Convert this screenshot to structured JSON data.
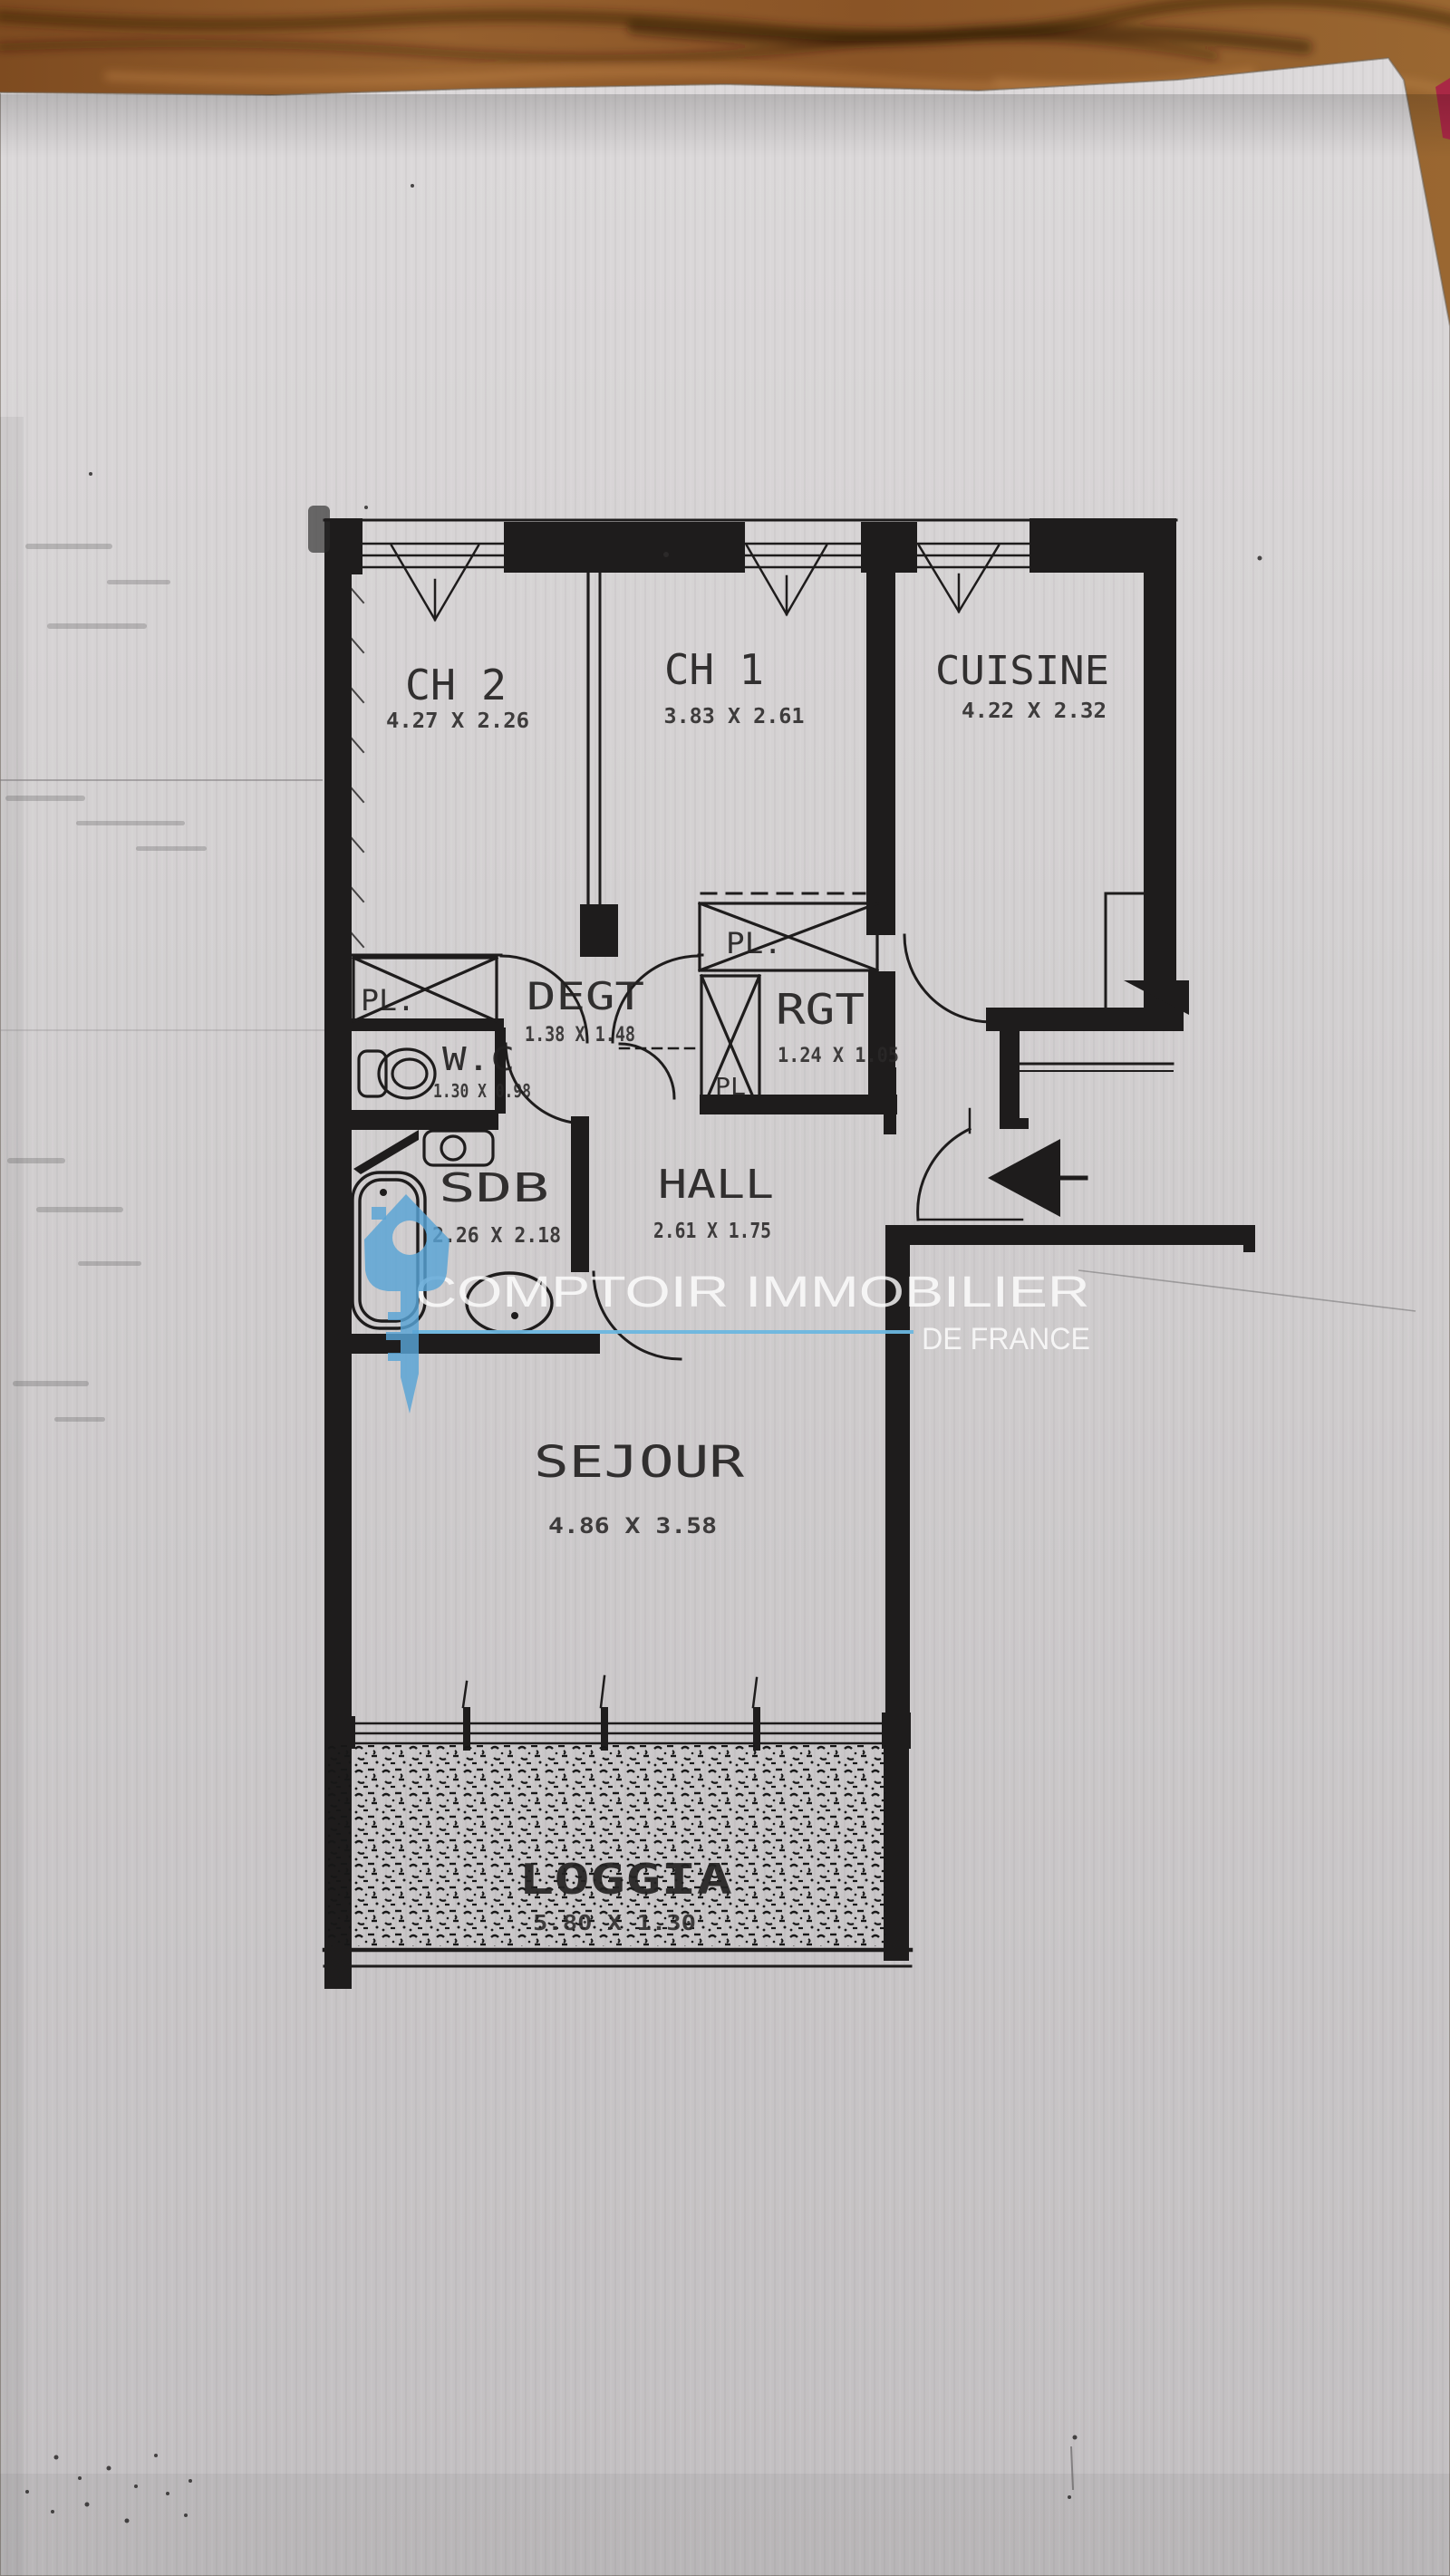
{
  "scene": {
    "description": "Photograph of a photocopied apartment floor plan lying on a wooden table",
    "paper_color": "#d3d0d1",
    "wood_color": "#8a5729",
    "ink_color": "#1e1c1c"
  },
  "watermark": {
    "line1": "COMPTOIR IMMOBILIER",
    "line2": "DE FRANCE",
    "accent_color": "#5aa5d7"
  },
  "floor_plan": {
    "rooms": [
      {
        "id": "ch2",
        "name": "CH 2",
        "dims": "4.27 X 2.26"
      },
      {
        "id": "ch1",
        "name": "CH 1",
        "dims": "3.83 X 2.61"
      },
      {
        "id": "cuisine",
        "name": "CUISINE",
        "dims": "4.22 X 2.32"
      },
      {
        "id": "degt",
        "name": "DEGT",
        "dims": "1.38 X 1.48"
      },
      {
        "id": "wc",
        "name": "W.C",
        "dims": "1.30 X 0.98"
      },
      {
        "id": "rgt",
        "name": "RGT",
        "dims": "1.24 X 1.05"
      },
      {
        "id": "sdb",
        "name": "SDB",
        "dims": "2.26 X 2.18"
      },
      {
        "id": "hall",
        "name": "HALL",
        "dims": "2.61 X 1.75"
      },
      {
        "id": "sejour",
        "name": "SEJOUR",
        "dims": "4.86 X 3.58"
      },
      {
        "id": "loggia",
        "name": "LOGGIA",
        "dims": "5.80 X 1.30"
      }
    ],
    "closets": [
      {
        "label": "PL."
      },
      {
        "label": "PL."
      },
      {
        "label": "PL"
      }
    ]
  }
}
